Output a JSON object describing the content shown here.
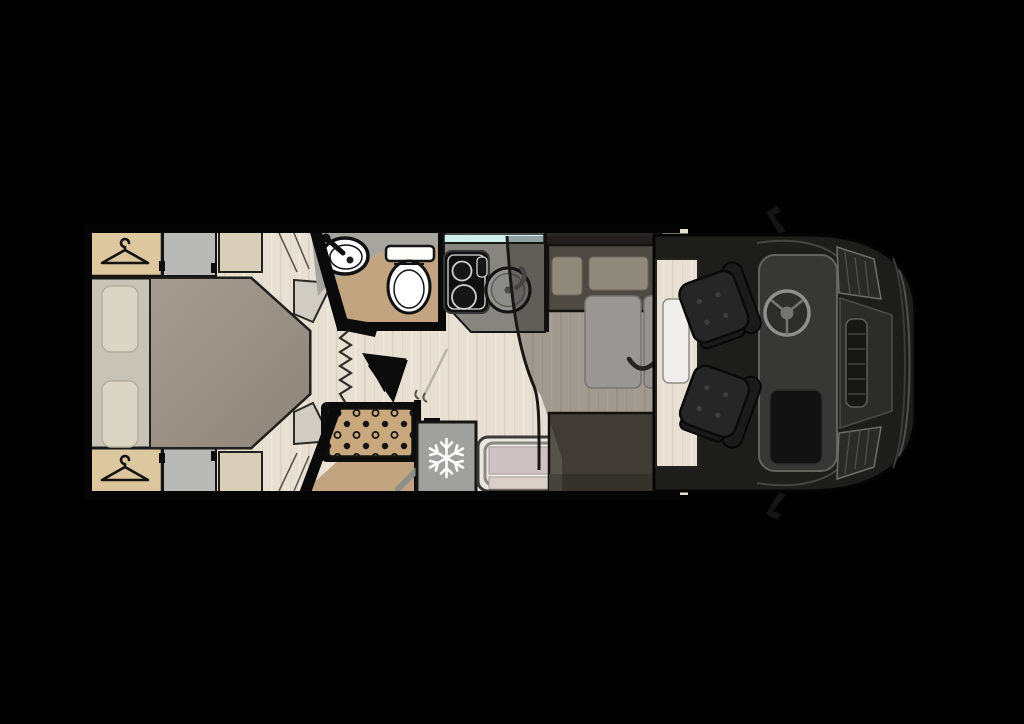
{
  "canvas": {
    "width": 1024,
    "height": 724,
    "background": "#000000"
  },
  "floorplan": {
    "type": "motorhome-top-view",
    "areas": [
      {
        "id": "bedroom",
        "label": "island-bed-bedroom"
      },
      {
        "id": "bathroom",
        "label": "washroom-basin-toilet"
      },
      {
        "id": "shower",
        "label": "shower-cubicle"
      },
      {
        "id": "kitchen",
        "label": "kitchen-hob-sink"
      },
      {
        "id": "lounge",
        "label": "dinette-with-drop-down-bed"
      },
      {
        "id": "entrance",
        "label": "entry-door-step"
      },
      {
        "id": "cab",
        "label": "driver-cab-swivel-seats"
      }
    ],
    "fixtures": {
      "fridge": {
        "icon_name": "snowflake-icon",
        "icon_glyph": "❄"
      },
      "wardrobe_top": {
        "icon_name": "hanger-icon"
      },
      "wardrobe_bottom": {
        "icon_name": "hanger-icon"
      },
      "privacy_door": {
        "style": "concertina-zigzag"
      },
      "door_swing": {
        "icon_name": "double-curved-arrow-icon"
      }
    },
    "palette": {
      "background": "#000000",
      "floor_wood": "#e8e1d3",
      "wardrobe_wood": "#dcc79e",
      "cabinet_grey": "#b9b9b8",
      "mattress": "#c8c3b7",
      "duvet": "#9b9389",
      "pillow": "#dad5c5",
      "bathroom_counter": "#a7a5a0",
      "bathroom_floor_tan": "#c3a480",
      "fixture_white": "#ffffff",
      "kitchen_counter": "#87857f",
      "window_glass": "#cfeeec",
      "fridge_grey": "#a0a09e",
      "snowflake_white": "#ffffff",
      "table_grey": "#dcdcd8",
      "bench_dark": "#56534a",
      "cushion_beige": "#cfc9b7",
      "drop_down_bed_shadow": "rgba(22,19,16,0.34)",
      "cab_body": "#1d1d1c",
      "seat_black": "#262626",
      "entry_panel": "#cfc2c4",
      "shower_tray_tan": "#c9a87e"
    }
  }
}
